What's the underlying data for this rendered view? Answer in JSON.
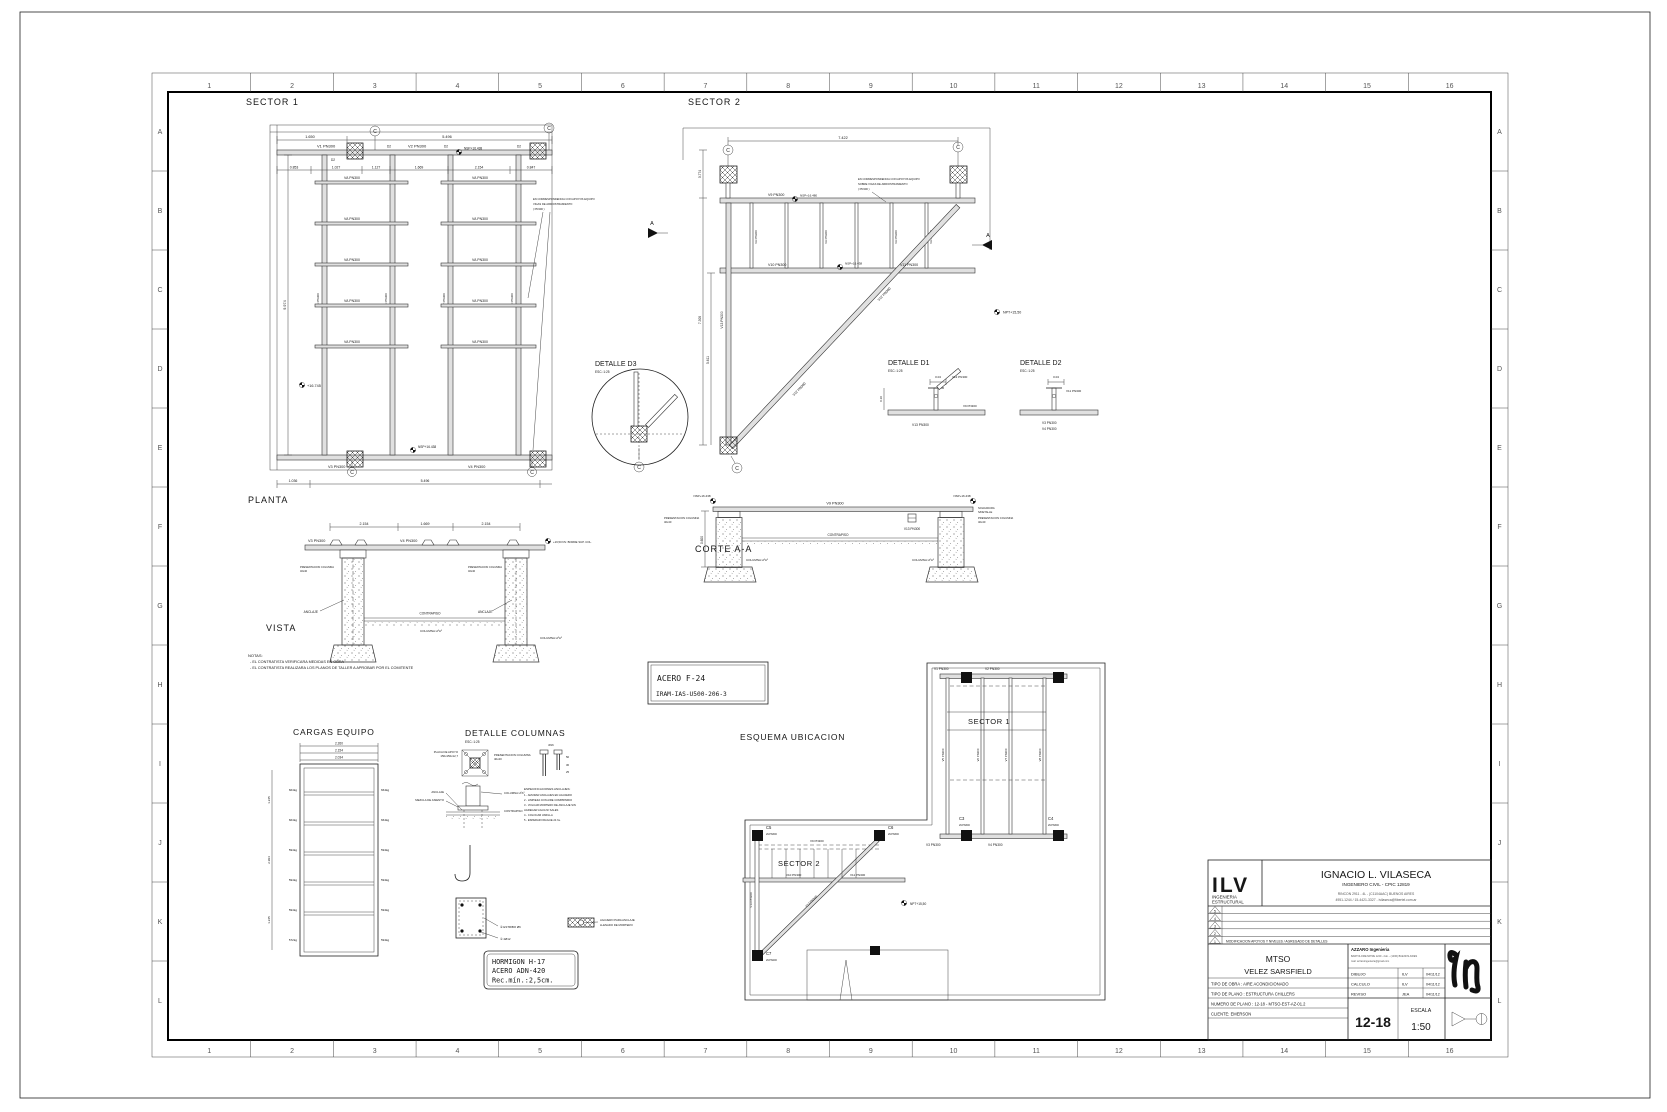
{
  "sheet": {
    "cols": [
      "1",
      "2",
      "3",
      "4",
      "5",
      "6",
      "7",
      "8",
      "9",
      "10",
      "11",
      "12",
      "13",
      "14",
      "15",
      "16"
    ],
    "rows": [
      "A",
      "B",
      "C",
      "D",
      "E",
      "F",
      "G",
      "H",
      "I",
      "J",
      "K",
      "L"
    ]
  },
  "sym": {
    "c": "C",
    "a": "A"
  },
  "titleblock": {
    "logo": "ILV",
    "logo_sub1": "INGENIERIA",
    "logo_sub2": "ESTRUCTURAL",
    "engineer": "IGNACIO L. VILASECA",
    "engineer_sub": "INGENIERO  CIVIL   -   CPIC  12819",
    "addr1": "RINCON 2911 - 4L - (C1104AAC) BUENOS AIRES",
    "addr2": "4951-1244 / 15-4421-3327  -  ivilaseca@fibertel.com.ar",
    "rev": [
      "5",
      "4",
      "3",
      "2",
      "1"
    ],
    "rev_note": "MODIFICACION APOYOS Y NIVELES / AGREGADO DE DETALLES",
    "project1": "MTSO",
    "project2": "VELEZ SARSFIELD",
    "company": "AZZARO Ingenieria",
    "company2": "BARTOLOME MITRE 1249 - 2do. - (1036) BUENOS AIRES",
    "company3": "mail: azzaroingenieria@gmail.com",
    "dibujo": "DIBUJO",
    "dibujo_v": "ILV",
    "date1": "04/11/12",
    "calculo": "CALCULO",
    "calculo_v": "ILV",
    "date2": "04/11/12",
    "reviso": "REVISO",
    "reviso_v": "JEA",
    "date3": "04/11/12",
    "tipo_obra": "TIPO DE OBRA : AIRE ACONDICIONADO",
    "tipo_plano": "TIPO DE PLANO : ESTRUCTURA CHILLERS",
    "numero_plano": "NUMERO DE PLANO : 12-18 - MTSO-EST-AZ-01.2",
    "cliente": "CLIENTE: EMERSON",
    "num": "12-18",
    "escala": "ESCALA",
    "escala_v": "1:50"
  },
  "s1": {
    "title": "SECTOR 1",
    "planta": "PLANTA",
    "dim_top": [
      "1.650",
      "5.496"
    ],
    "dim_row": [
      "0.853",
      "1.027",
      "1.127",
      "1.669",
      "2.154",
      "0.847"
    ],
    "dim_bottom": [
      "1.036",
      "5.496"
    ],
    "dim_left": "9.974",
    "v1": "V1 PN300",
    "v2": "V2 PN300",
    "v3": "V3 PN300",
    "v4": "V4 PN300",
    "v5": "V5 PN300",
    "v6": "V6 PN300",
    "v7": "V7 PN300",
    "v8": "V8 PN300",
    "va": "VA PN300",
    "d2": "D2",
    "nsp": "NSP+16.438",
    "level": "+16.745",
    "note1": "EN CORRESPONDENCIA CON APOYOS EQUIPO",
    "note2": "VIGAS DE ARRIOSTRAMIENTO",
    "note3": "( PN300 )"
  },
  "s2": {
    "title": "SECTOR 2",
    "dim_top": "7.422",
    "dim_l1": "0.774",
    "dim_l2": "7.300",
    "dim_l3": "5.611",
    "v9": "V9 PN300",
    "v10": "V10 PN300",
    "v11": "V11 PN300",
    "v12": "V12 PN300",
    "v13": "V13 PN300",
    "va": "VA PN300",
    "nsp1": "NSP+16.480",
    "nsp2": "NSP+16.438",
    "npt": "NPT+15,50",
    "note1": "EN CORRESPONDENCIA CON APOYOS EQUIPO",
    "note2": "SOBRE VIGAS DE ARRIOSTRAMIENTO",
    "note3": "( PN300 )"
  },
  "d3": {
    "title": "DETALLE D3",
    "esc": "ESC.:1:25"
  },
  "d1": {
    "title": "DETALLE D1",
    "esc": "ESC.:1:25",
    "dim": "0.04",
    "dim2": "0.10",
    "v12": "V12 PN300",
    "v9": "V9 PN300",
    "v13": "V13 PN300"
  },
  "dd2": {
    "title": "DETALLE D2",
    "esc": "ESC.:1:25",
    "dim": "0.04",
    "v11": "V11 PN300",
    "v3": "V3 PN300",
    "v4": "V4 PN300"
  },
  "corte": {
    "title": "CORTE A-A",
    "v9": "V9 PN300",
    "v13": "V13 PN300",
    "nsp": "NSP+16.438",
    "contrapiso": "CONTRAPISO",
    "columna": "COLUMNA HºAº",
    "pres1": "PRESENTACION COLUMNA",
    "pres2": "40x40",
    "sold1": "SOLDADURA",
    "sold2": "S/DETALLE",
    "dim": "0.600"
  },
  "vista": {
    "title": "VISTA",
    "dims": [
      "2.154",
      "1.669",
      "2.154"
    ],
    "v3": "V3 PN300",
    "v4": "V4 PN300",
    "level": "+16,50 NV. BORDE SUP. COL.",
    "anclaje": "ANCLAJE",
    "contrapiso": "CONTRAPISO",
    "columna": "COLUMNA HºAº",
    "pres1": "PRESENTACION COLUMNA",
    "pres2": "40x40"
  },
  "notas": {
    "title": "NOTAS:",
    "l1": "- EL CONTRATISTA VERIFICARA MEDIDAS EN OBRA",
    "l2": "- EL CONTRATISTA REALIZARA LOS PLANOS DE TALLER A APROBAR POR EL COMITENTE"
  },
  "acero": {
    "l1": "ACERO  F-24",
    "l2": "IRAM-IAS-U500-206-3"
  },
  "hormigon": {
    "l1": "HORMIGON  H-17",
    "l2": "ACERO  ADN-420",
    "l3": "Rec.mín.:2,5cm."
  },
  "cargas": {
    "title": "CARGAS EQUIPO",
    "dims_top": [
      "2.260",
      "2.154",
      "2.034"
    ],
    "left": [
      "664kg",
      "664kg",
      "594kg",
      "594kg",
      "594kg",
      "572kg"
    ],
    "right": [
      "664kg",
      "664kg",
      "594kg",
      "594kg",
      "594kg",
      "594kg"
    ],
    "dims_left": [
      "1.245",
      "2.994",
      "1.245"
    ]
  },
  "detcol": {
    "title": "DETALLE COLUMNAS",
    "esc": "ESC.:1:25",
    "placa1": "PLACA DE APOYO",
    "placa2": "150x150x12,7",
    "pres1": "PRESENTACION COLUMNA",
    "pres2": "40x40",
    "anclaje": "ANCLAJE",
    "contrapiso": "CONTRAPISO",
    "mezcla": "MEZCLA DE ASIENTO",
    "columna": "COLUMNA HºAº",
    "bolt": "Ø16",
    "bolt_dims": [
      "50",
      "30",
      "25"
    ],
    "espec_title": "ESPECIFICACIONES ANCLAJES:",
    "espec": [
      "1 - AMURAR ANCLAJES EN AGUJERO",
      "2 - LIMPIEZA CON AIRE COMPRIMIDO",
      "3 - VOLCAR MORTERO DE ANCLAJE SIN",
      "     AGREGAR AGUA NI SALES",
      "4 - COLOCAR VARILLA",
      "5 - ESPERAR FRAGUE 24 hs."
    ],
    "reb1": "② ESTRIBO Ø6",
    "reb2": "① 4Ø12",
    "aguj1": "AGUJERO PARA ANCLAJE",
    "aguj2": "LLENADO DE MORTERO"
  },
  "esq": {
    "title": "ESQUEMA UBICACION",
    "sector1": "SECTOR 1",
    "sector2": "SECTOR 2",
    "v1": "V1 PN300",
    "v2": "V2 PN300",
    "v3": "V3 PN300",
    "v4": "V4 PN300",
    "v5": "V5 PN300",
    "v6": "V6 PN300",
    "v7": "V7 PN300",
    "v8": "V8 PN300",
    "v9": "V9 PN300",
    "v10": "V10 PN300",
    "v11": "V11 PN300",
    "v12": "V12 PN300",
    "v13": "V13 PN300",
    "c3": "C3",
    "c4": "C4",
    "c5": "C5",
    "c6": "C6",
    "c7": "C7",
    "s300": "2UPN300",
    "s200": "2UPN200",
    "npt": "NPT+15,50"
  }
}
